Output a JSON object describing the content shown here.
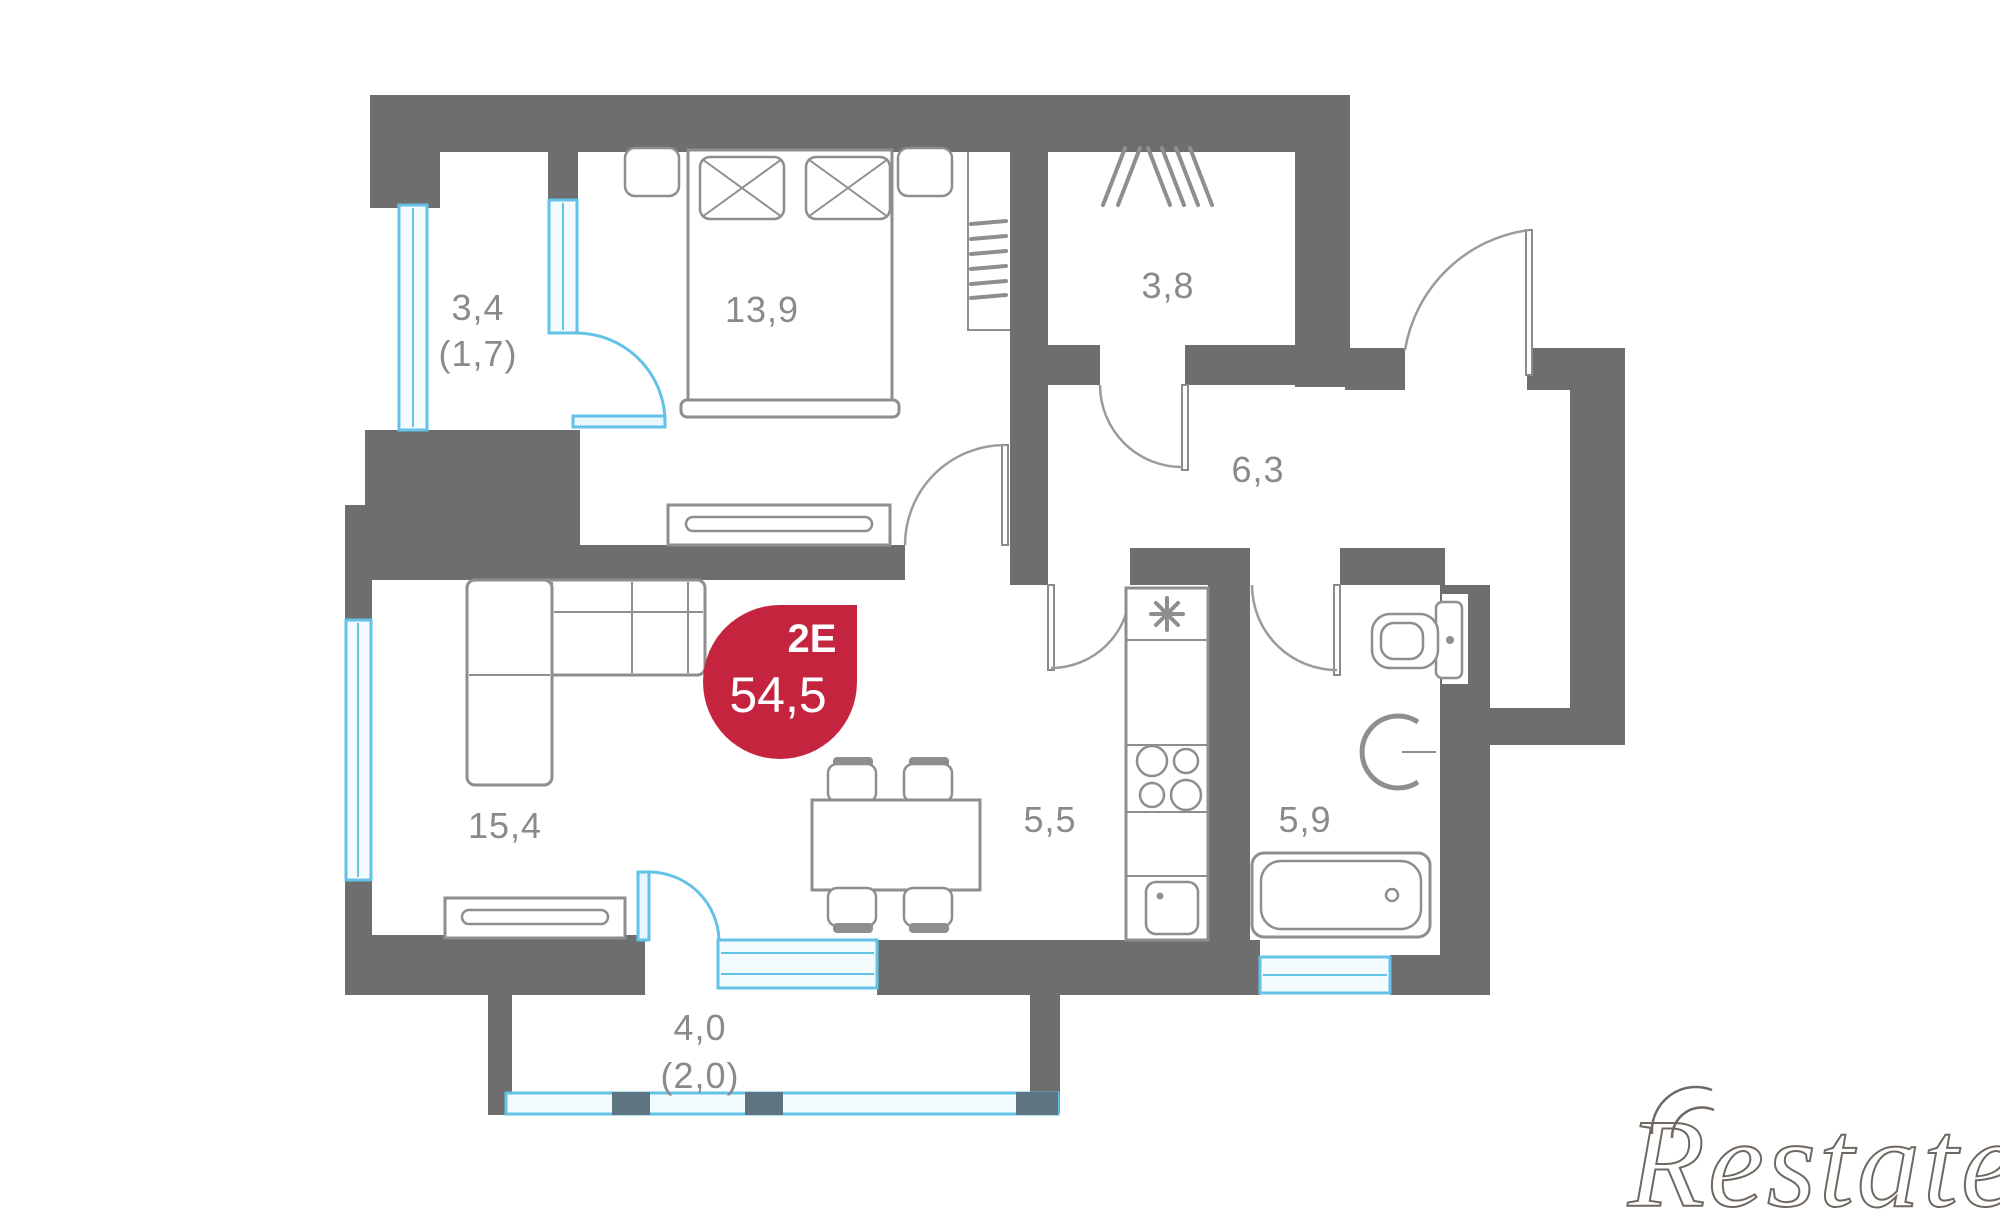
{
  "plan": {
    "badge": {
      "unit_type": "2E",
      "area": "54,5"
    },
    "rooms": [
      {
        "id": "balcony-left",
        "label": "3,4",
        "sublabel": "(1,7)"
      },
      {
        "id": "bedroom",
        "label": "13,9"
      },
      {
        "id": "wardrobe",
        "label": "3,8"
      },
      {
        "id": "hallway",
        "label": "6,3"
      },
      {
        "id": "living-room",
        "label": "15,4"
      },
      {
        "id": "kitchen",
        "label": "5,5"
      },
      {
        "id": "bathroom",
        "label": "5,9"
      },
      {
        "id": "balcony-bottom",
        "label": "4,0",
        "sublabel": "(2,0)"
      }
    ],
    "watermark": "Restate",
    "colors": {
      "wall": "#6E6E6E",
      "line": "#8E8E8E",
      "glazing": "#63C2E6",
      "glazing_fill": "#F4FBFE",
      "mullion": "#5E7480",
      "badge": "#C4243E",
      "badge_text": "#FFFFFF",
      "label": "#8A8A8A",
      "watermark": "#6F6860"
    }
  }
}
